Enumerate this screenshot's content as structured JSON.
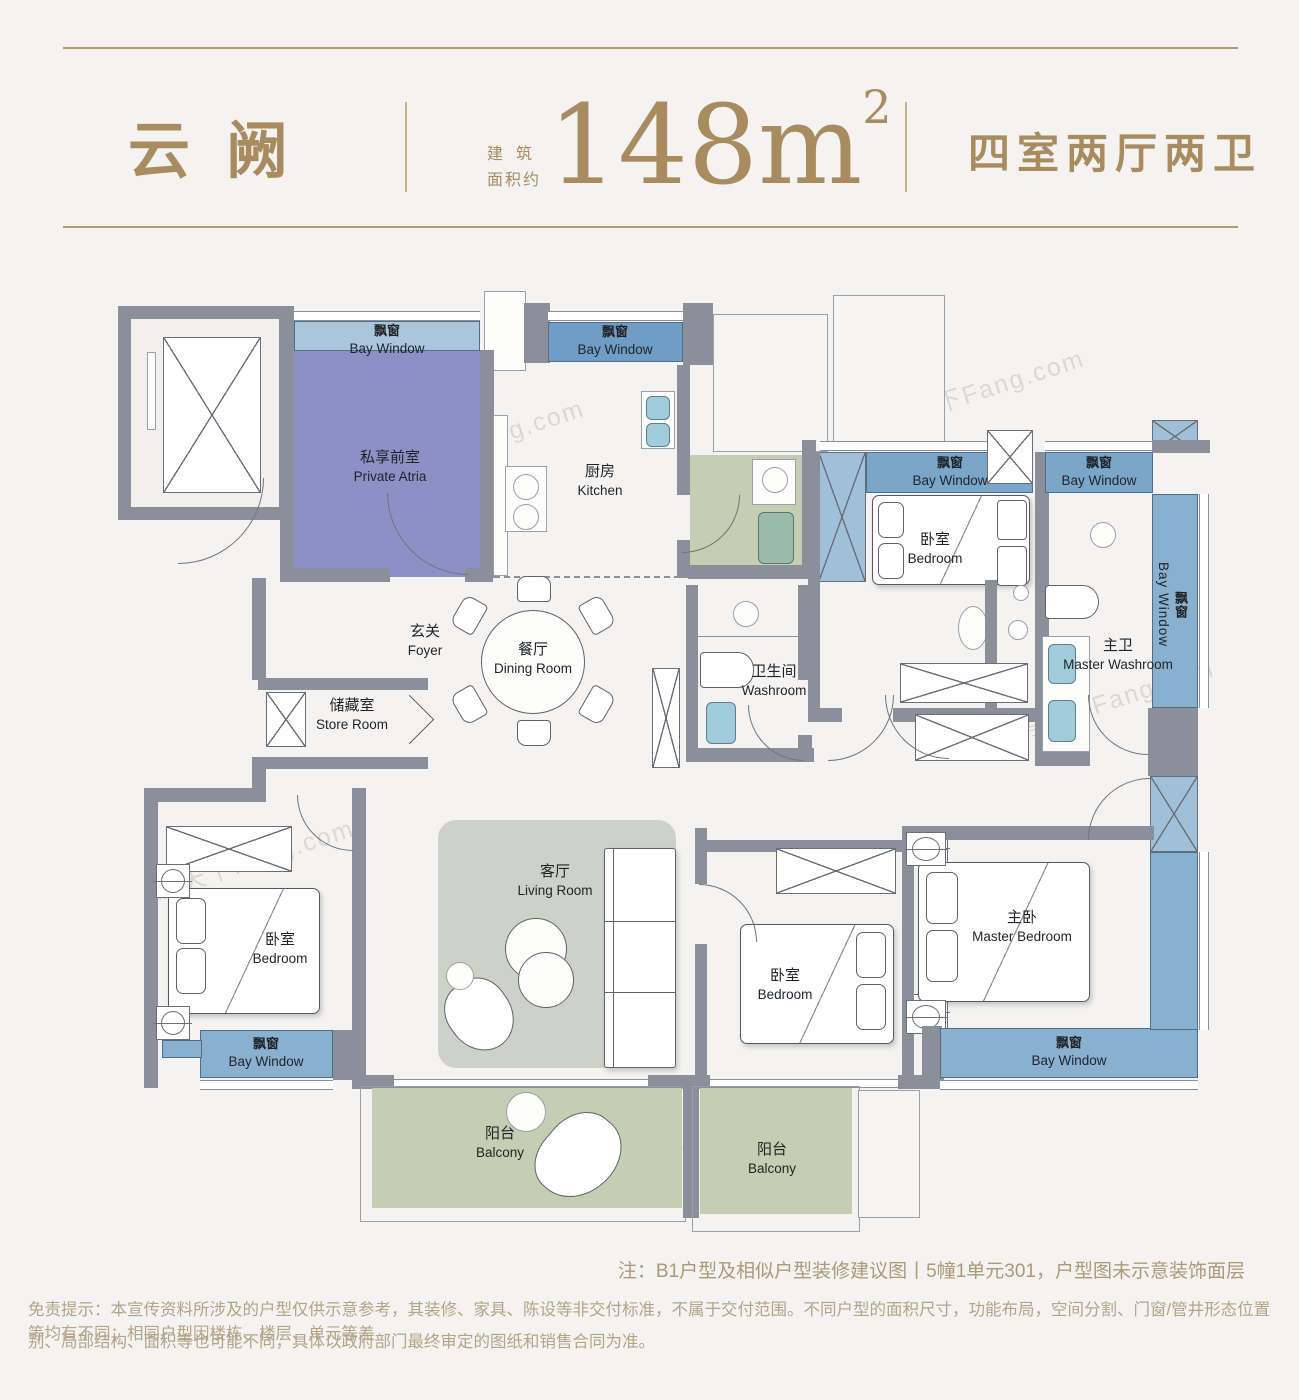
{
  "header": {
    "title": "云阙",
    "area_label_line1": "建筑",
    "area_label_line2": "面积约",
    "area_value": "148m",
    "area_superscript": "2",
    "layout_text": "四室两厅两卫"
  },
  "rooms": {
    "private_atria": {
      "zh": "私享前室",
      "en": "Private Atria"
    },
    "kitchen": {
      "zh": "厨房",
      "en": "Kitchen"
    },
    "foyer": {
      "zh": "玄关",
      "en": "Foyer"
    },
    "dining": {
      "zh": "餐厅",
      "en": "Dining Room"
    },
    "store": {
      "zh": "储藏室",
      "en": "Store Room"
    },
    "washroom": {
      "zh": "卫生间",
      "en": "Washroom"
    },
    "master_washroom": {
      "zh": "主卫",
      "en": "Master Washroom"
    },
    "bedroom": {
      "zh": "卧室",
      "en": "Bedroom"
    },
    "master_bedroom": {
      "zh": "主卧",
      "en": "Master Bedroom"
    },
    "living": {
      "zh": "客厅",
      "en": "Living Room"
    },
    "balcony": {
      "zh": "阳台",
      "en": "Balcony"
    },
    "bay_window": {
      "zh": "飘窗",
      "en": "Bay Window"
    }
  },
  "notes": {
    "note": "注：B1户型及相似户型装修建议图丨5幢1单元301，户型图未示意装饰面层",
    "disclaimer_line1": "免责提示：本宣传资料所涉及的户型仅供示意参考，其装修、家具、陈设等非交付标准，不属于交付范围。不同户型的面积尺寸，功能布局，空间分割、门窗/管井形态位置等均有不同；相同户型因楼栋、楼层、单元等差",
    "disclaimer_line2": "别、局部结构、面积等也可能不同，具体以政府部门最终审定的图纸和销售合同为准。"
  },
  "watermark": "房天下Fang.com",
  "colors": {
    "gold": "#a88c60",
    "wall_gray": "#8b8f9a",
    "bay_window_light": "#a9c6dd",
    "bay_window_mid": "#6f9dc6",
    "bay_window_deep": "#8ab0d0",
    "private_atria_purple": "#8d90c5",
    "balcony_green": "#c3ceb2",
    "living_rug": "#cdd1c7",
    "fixture_blue": "#a3ccdb"
  }
}
